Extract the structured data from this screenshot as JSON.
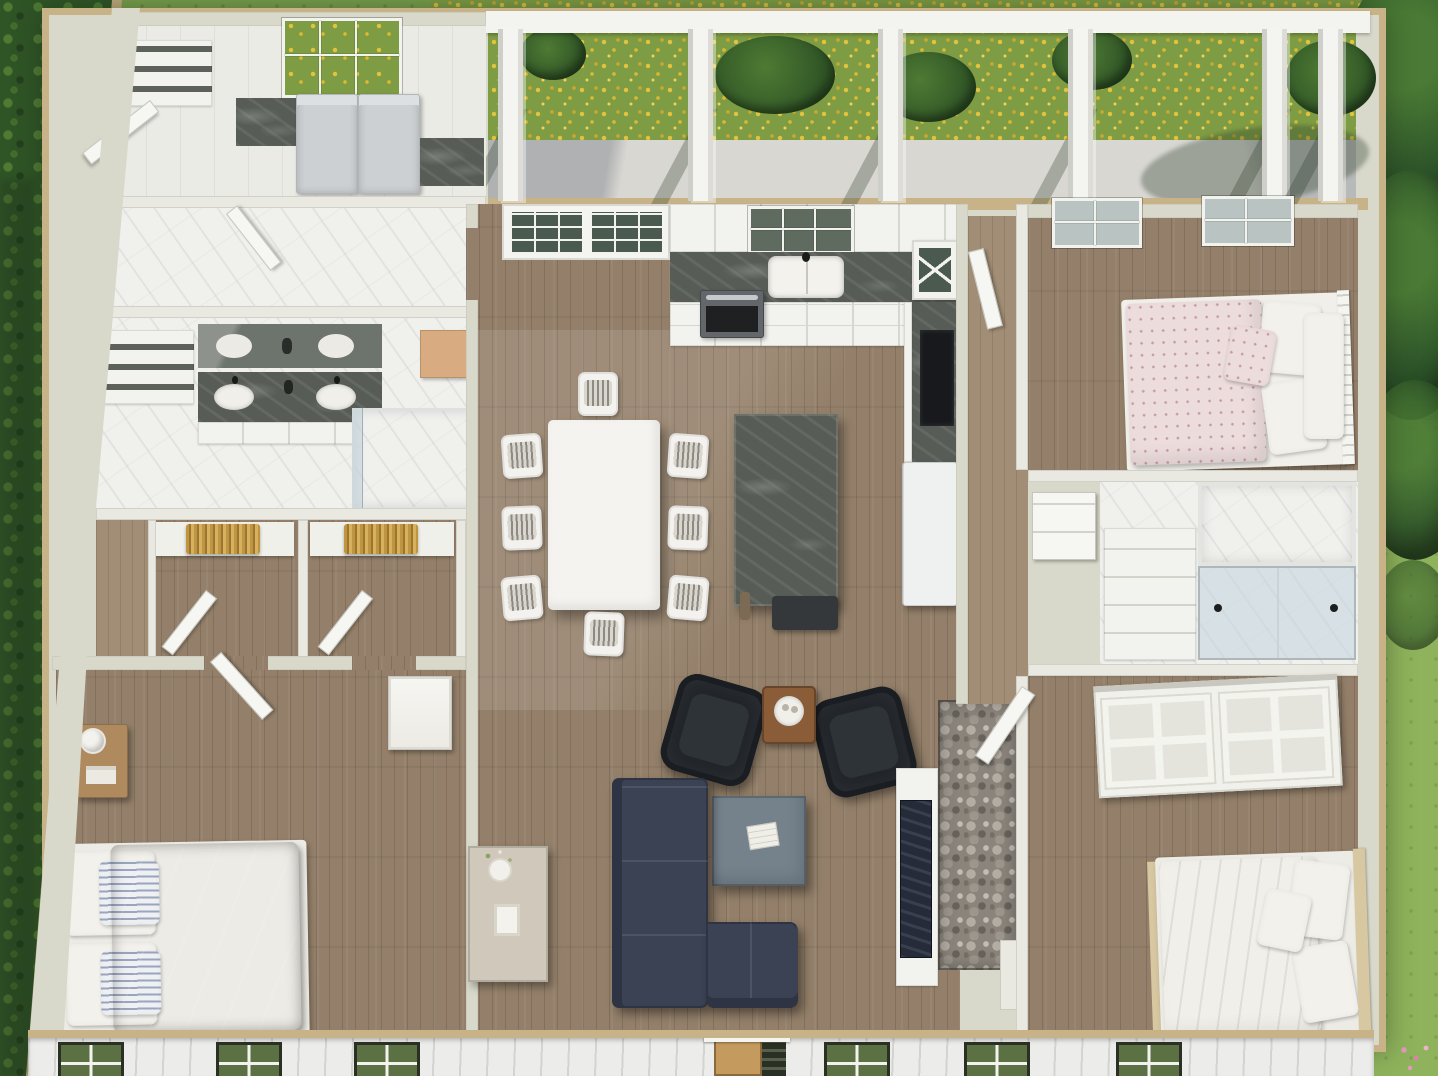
{
  "scene": {
    "title": "3D aerial dollhouse cutaway rendering of a single-story farmhouse floor plan, viewed top-down on a green lawn",
    "view": "top-down cutaway 3D render",
    "setting": "lawn with ivy ground cover on the left, trees on the right, yellow flower beds behind a covered rear porch"
  },
  "palette": {
    "grass": "#79a04c",
    "grass_light": "#8fb35c",
    "bush": "#2f5426",
    "tree": "#2b5128",
    "flower_yellow": "#e3c23c",
    "flowerbed_green": "#7e9c44",
    "porch_floor": "#d8d7d2",
    "beam_white": "#f3f3ef",
    "wall_tan": "#c8b388",
    "wall_face": "#d9d9cb",
    "wall_light": "#e9e9e1",
    "floor_wood": "#94806a",
    "floor_wood_light": "#a28e76",
    "floor_tile": "#ebebe6",
    "marble": "#f0f0ed",
    "counter_dark": "#575d56",
    "cabinet_white": "#f2f2ee",
    "cabinet_seam": "#d7d7d1",
    "appliance_gray": "#ccd0d3",
    "range_gray": "#63676b",
    "black_appliance": "#17191c",
    "navy_duvet": "#3e53a0",
    "sofa_navy": "#3b4254",
    "sofa_dark": "#2e3444",
    "armchair_black": "#212529",
    "coffee_table_blue": "#75828c",
    "wood_mid": "#8a5c38",
    "nightstand_wood": "#b08a5f",
    "console_greige": "#cfc8bb",
    "floral_base": "#ecdcdc",
    "floral_dot": "#c59da8",
    "bedding_white": "#f1efe9",
    "mattress_white": "#edebe5",
    "stone_base": "#8a847c",
    "stone_light": "#b3ada3",
    "stone_dark": "#67625b",
    "siding": "#ececea",
    "siding_line": "#d3d3cf",
    "window_frame_dark": "#2b3024",
    "window_glass_green": "#5c7143",
    "pane_glass": "#b9c4c2",
    "glass_pane_dark": "#4b5a4f",
    "shower_glass": "#c3d4dc",
    "door_wood": "#c49a5e",
    "gold_clothes": "#c09542",
    "pink_flower": "#e39ab8",
    "frame_tan": "#d8c8a2",
    "bench_wood": "#d9ab80"
  },
  "house": {
    "rooms": [
      {
        "id": "laundry",
        "label": "Laundry / Utility Room"
      },
      {
        "id": "mudroom",
        "label": "Mudroom Hall"
      },
      {
        "id": "primary-bath",
        "label": "Primary Bathroom with double vanity"
      },
      {
        "id": "walk-in-closets",
        "label": "Two Walk-in Closets"
      },
      {
        "id": "primary-bedroom",
        "label": "Primary Bedroom with navy bed"
      },
      {
        "id": "kitchen",
        "label": "Kitchen with island"
      },
      {
        "id": "dining",
        "label": "Dining Area with 8-chair table"
      },
      {
        "id": "living",
        "label": "Living Room with sectional and fireplace"
      },
      {
        "id": "hallway",
        "label": "Hallway"
      },
      {
        "id": "bedroom-2",
        "label": "Bedroom 2 with floral bed"
      },
      {
        "id": "bathroom-2",
        "label": "Bathroom 2 with marble shower"
      },
      {
        "id": "bedroom-3",
        "label": "Bedroom 3 with white bed and sliding-door closet"
      },
      {
        "id": "porch",
        "label": "Covered Rear Porch"
      }
    ],
    "porch": {
      "columns_x": [
        498,
        688,
        878,
        1068,
        1262,
        1318
      ],
      "material": "concrete slab, white square columns and beam"
    },
    "facade": {
      "windows_x": [
        58,
        216,
        354,
        824,
        964,
        1116
      ],
      "door_x": 714,
      "style": "white board-and-batten siding, dark-framed windows reflecting green, wood front door"
    },
    "furniture": {
      "dining_chairs": [
        {
          "x": 502,
          "y": 434,
          "r": -4
        },
        {
          "x": 502,
          "y": 506,
          "r": -2
        },
        {
          "x": 502,
          "y": 576,
          "r": -5
        },
        {
          "x": 668,
          "y": 434,
          "r": 4
        },
        {
          "x": 668,
          "y": 506,
          "r": 2
        },
        {
          "x": 668,
          "y": 576,
          "r": 5
        },
        {
          "x": 578,
          "y": 372,
          "r": 0
        },
        {
          "x": 584,
          "y": 612,
          "r": 2
        }
      ],
      "inventory": [
        "washer",
        "dryer",
        "double-vanity with 2 sinks and mirror",
        "walk-in shower x2",
        "navy king bed",
        "floral full bed",
        "white queen bed",
        "nightstand with lamp",
        "white dining table",
        "kitchen island",
        "farmhouse sink",
        "range",
        "refrigerator",
        "navy L-sectional sofa",
        "2 black leather armchairs",
        "blue-gray coffee table",
        "wood side table",
        "greige console with plant",
        "stone fireplace with TV wall"
      ]
    }
  }
}
